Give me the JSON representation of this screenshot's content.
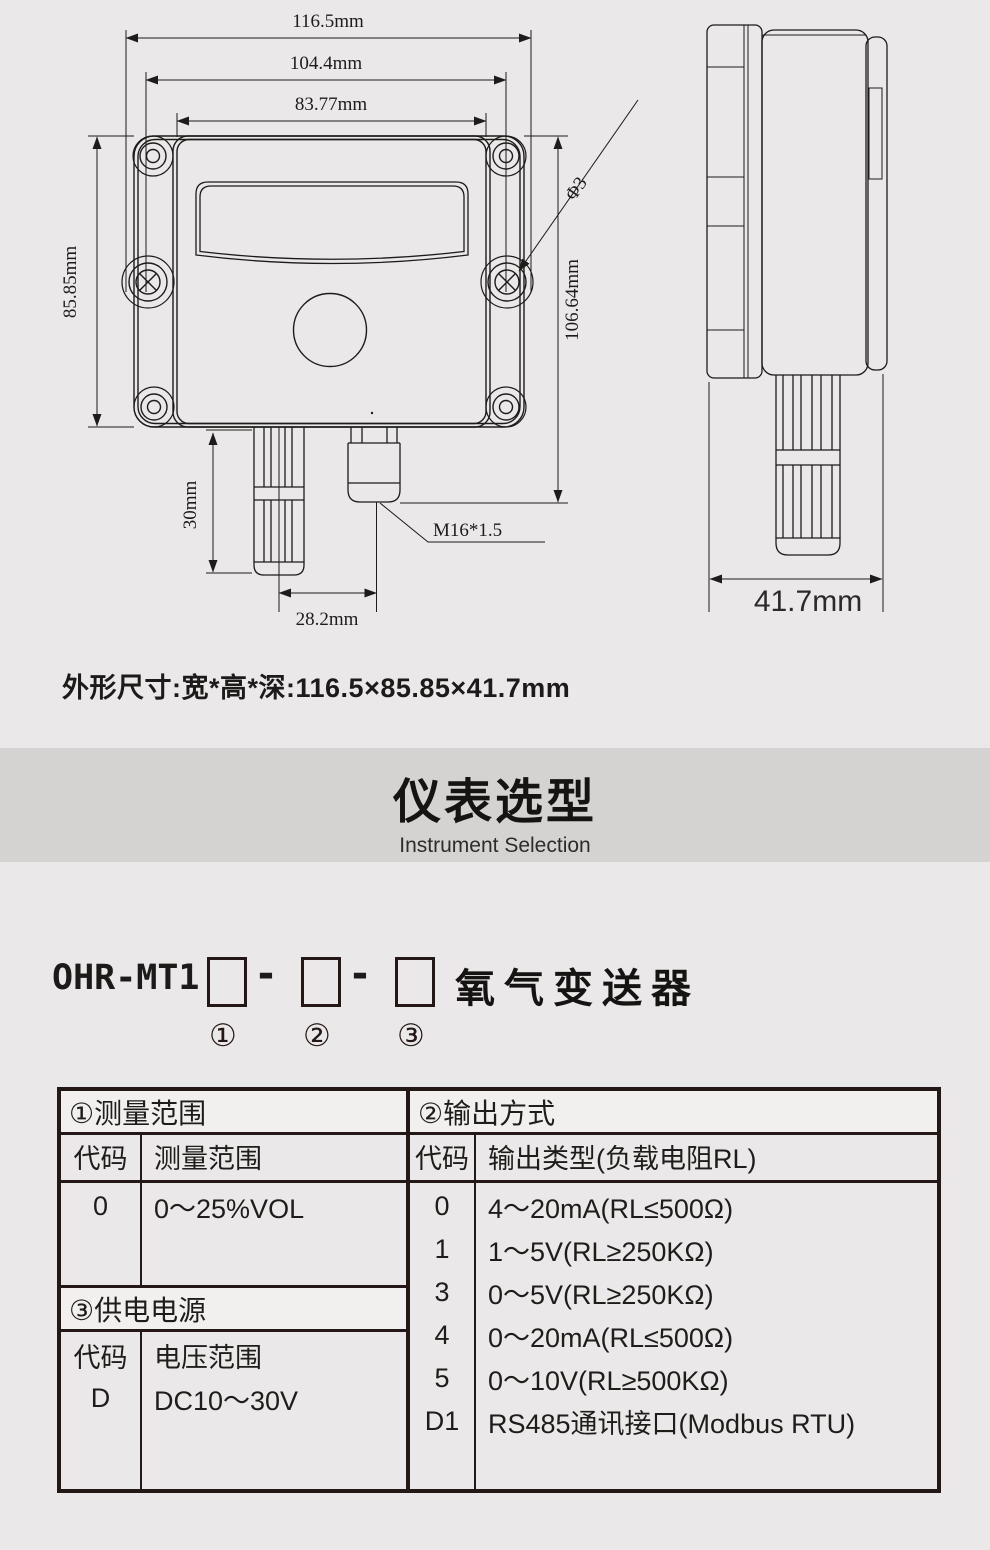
{
  "drawing": {
    "front": {
      "dim_width_outer": "116.5mm",
      "dim_width_holes": "104.4mm",
      "dim_width_inner": "83.77mm",
      "dim_height": "85.85mm",
      "dim_height_overall": "106.64mm",
      "dim_probe_length": "30mm",
      "dim_probe_offset": "28.2mm",
      "thread_label": "M16*1.5",
      "hole_label": "Φ3"
    },
    "side": {
      "dim_depth": "41.7mm"
    }
  },
  "summary": "外形尺寸:宽*高*深:116.5×85.85×41.7mm",
  "banner": {
    "title": "仪表选型",
    "subtitle": "Instrument Selection"
  },
  "model": {
    "prefix": "OHR-MT1",
    "separator": "-",
    "suffix": "氧气变送器",
    "slots": [
      "①",
      "②",
      "③"
    ]
  },
  "selection_table": {
    "range": {
      "header": "①测量范围",
      "col_code": "代码",
      "col_value": "测量范围",
      "rows": [
        {
          "code": "0",
          "value": "0～25%VOL"
        }
      ]
    },
    "power": {
      "header": "③供电电源",
      "col_code": "代码",
      "col_value": "电压范围",
      "rows": [
        {
          "code": "D",
          "value": "DC10～30V"
        }
      ]
    },
    "output": {
      "header": "②输出方式",
      "col_code": "代码",
      "col_value": "输出类型(负载电阻RL)",
      "rows": [
        {
          "code": "0",
          "value": "4～20mA(RL≤500Ω)"
        },
        {
          "code": "1",
          "value": "1～5V(RL≥250KΩ)"
        },
        {
          "code": "3",
          "value": "0～5V(RL≥250KΩ)"
        },
        {
          "code": "4",
          "value": "0～20mA(RL≤500Ω)"
        },
        {
          "code": "5",
          "value": "0～10V(RL≥500KΩ)"
        },
        {
          "code": "D1",
          "value": "RS485通讯接口(Modbus RTU)"
        }
      ]
    }
  },
  "colors": {
    "page_bg": "#eae8e8",
    "banner_bg": "#d5d2d2",
    "ink": "#231815"
  }
}
